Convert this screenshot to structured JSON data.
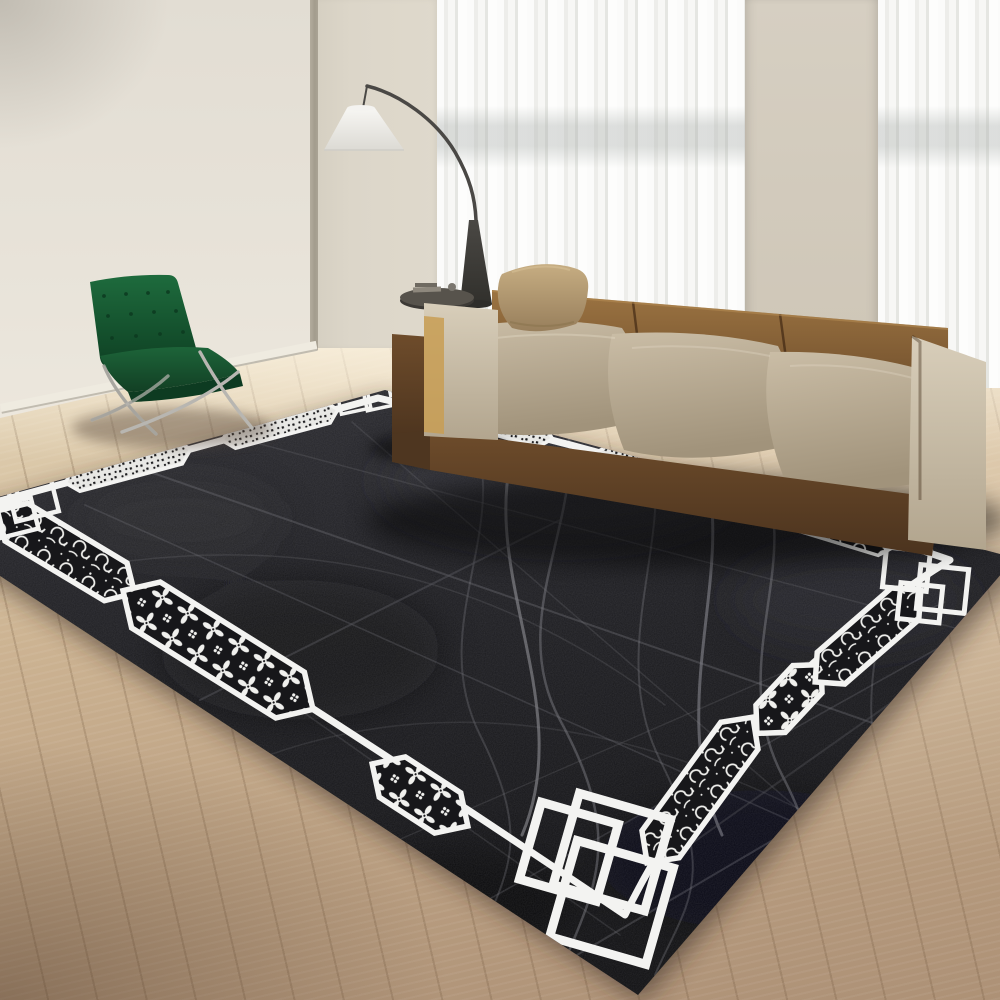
{
  "meta": {
    "type": "interior-photograph",
    "description": "Modern living room product photo: large black area rug with grey wavy line field and white geometric border of ornamental cartouches and interlocking squares; tan leather block sofa; emerald green Barcelona-style chair; white arc floor lamp; sheer white curtains; light oak plank floor",
    "width": 1000,
    "height": 1000
  },
  "colors": {
    "wall": "#e7e2d8",
    "wallPanel": "#dcd6c9",
    "wallColumn": "#d6cfc2",
    "frameLine": "#a39c8d",
    "curtain": "#f5f5f3",
    "baseboard": "#efebe0",
    "floorLight": "#e2d2b4",
    "floorMid": "#c9b08f",
    "floorDark": "#a18569",
    "plankSeam": "rgba(105,80,55,0.22)",
    "floorWash": "rgba(253,245,228,0.85)",
    "rugBlack": "#1b1b1e",
    "rugBlackLight": "#2c2c31",
    "rugBlackDeep": "#101012",
    "rugLine": "#85858c",
    "rugLineBright": "#9a9aa1",
    "rugWhite": "#f3f3f1",
    "sofaBrown": "#84603a",
    "sofaBrownLight": "#9c7442",
    "sofaBrownDark": "#5c3f24",
    "sofaTaupe": "#b4a58d",
    "sofaTaupeLight": "#cabda6",
    "sofaCream": "#cfc4b0",
    "sofaGold": "#c89e54",
    "pillowTan": "#b89d72",
    "chairGreen": "#175430",
    "chairGreenLight": "#1e6b3d",
    "chairGreenDark": "#0c3a20",
    "chrome": "#b8b6b1",
    "chromeDark": "#77756f",
    "lampShade": "#efeeea",
    "lampMetal": "#4a4845",
    "lampBase": "#3d3b37",
    "tableTop": "#57534c"
  },
  "objects": {
    "rug": {
      "field": "charcoal black with criss-crossing grey wavy lines",
      "border": "white band with black-and-white ornamental cartouches (floral, scroll, speckle) and interlocking square corner motifs"
    },
    "sofa": {
      "type": "three-seat modular leather sofa",
      "tones": [
        "caramel brown backrest",
        "taupe seat cushions",
        "cream armrests"
      ],
      "pillow": "tan leather throw pillow"
    },
    "chair": {
      "type": "Barcelona-style tufted lounge chair",
      "color": "emerald green",
      "frame": "chrome"
    },
    "lamp": {
      "type": "arc floor lamp",
      "shade": "white empire cone",
      "stem": "dark curved metal"
    },
    "side_table": {
      "type": "small round pedestal table",
      "top": "dark grey"
    },
    "curtains": "sheer white floor-length panels",
    "floor": "light oak planks laid diagonally",
    "walls": "warm cream with recessed panel and column"
  }
}
